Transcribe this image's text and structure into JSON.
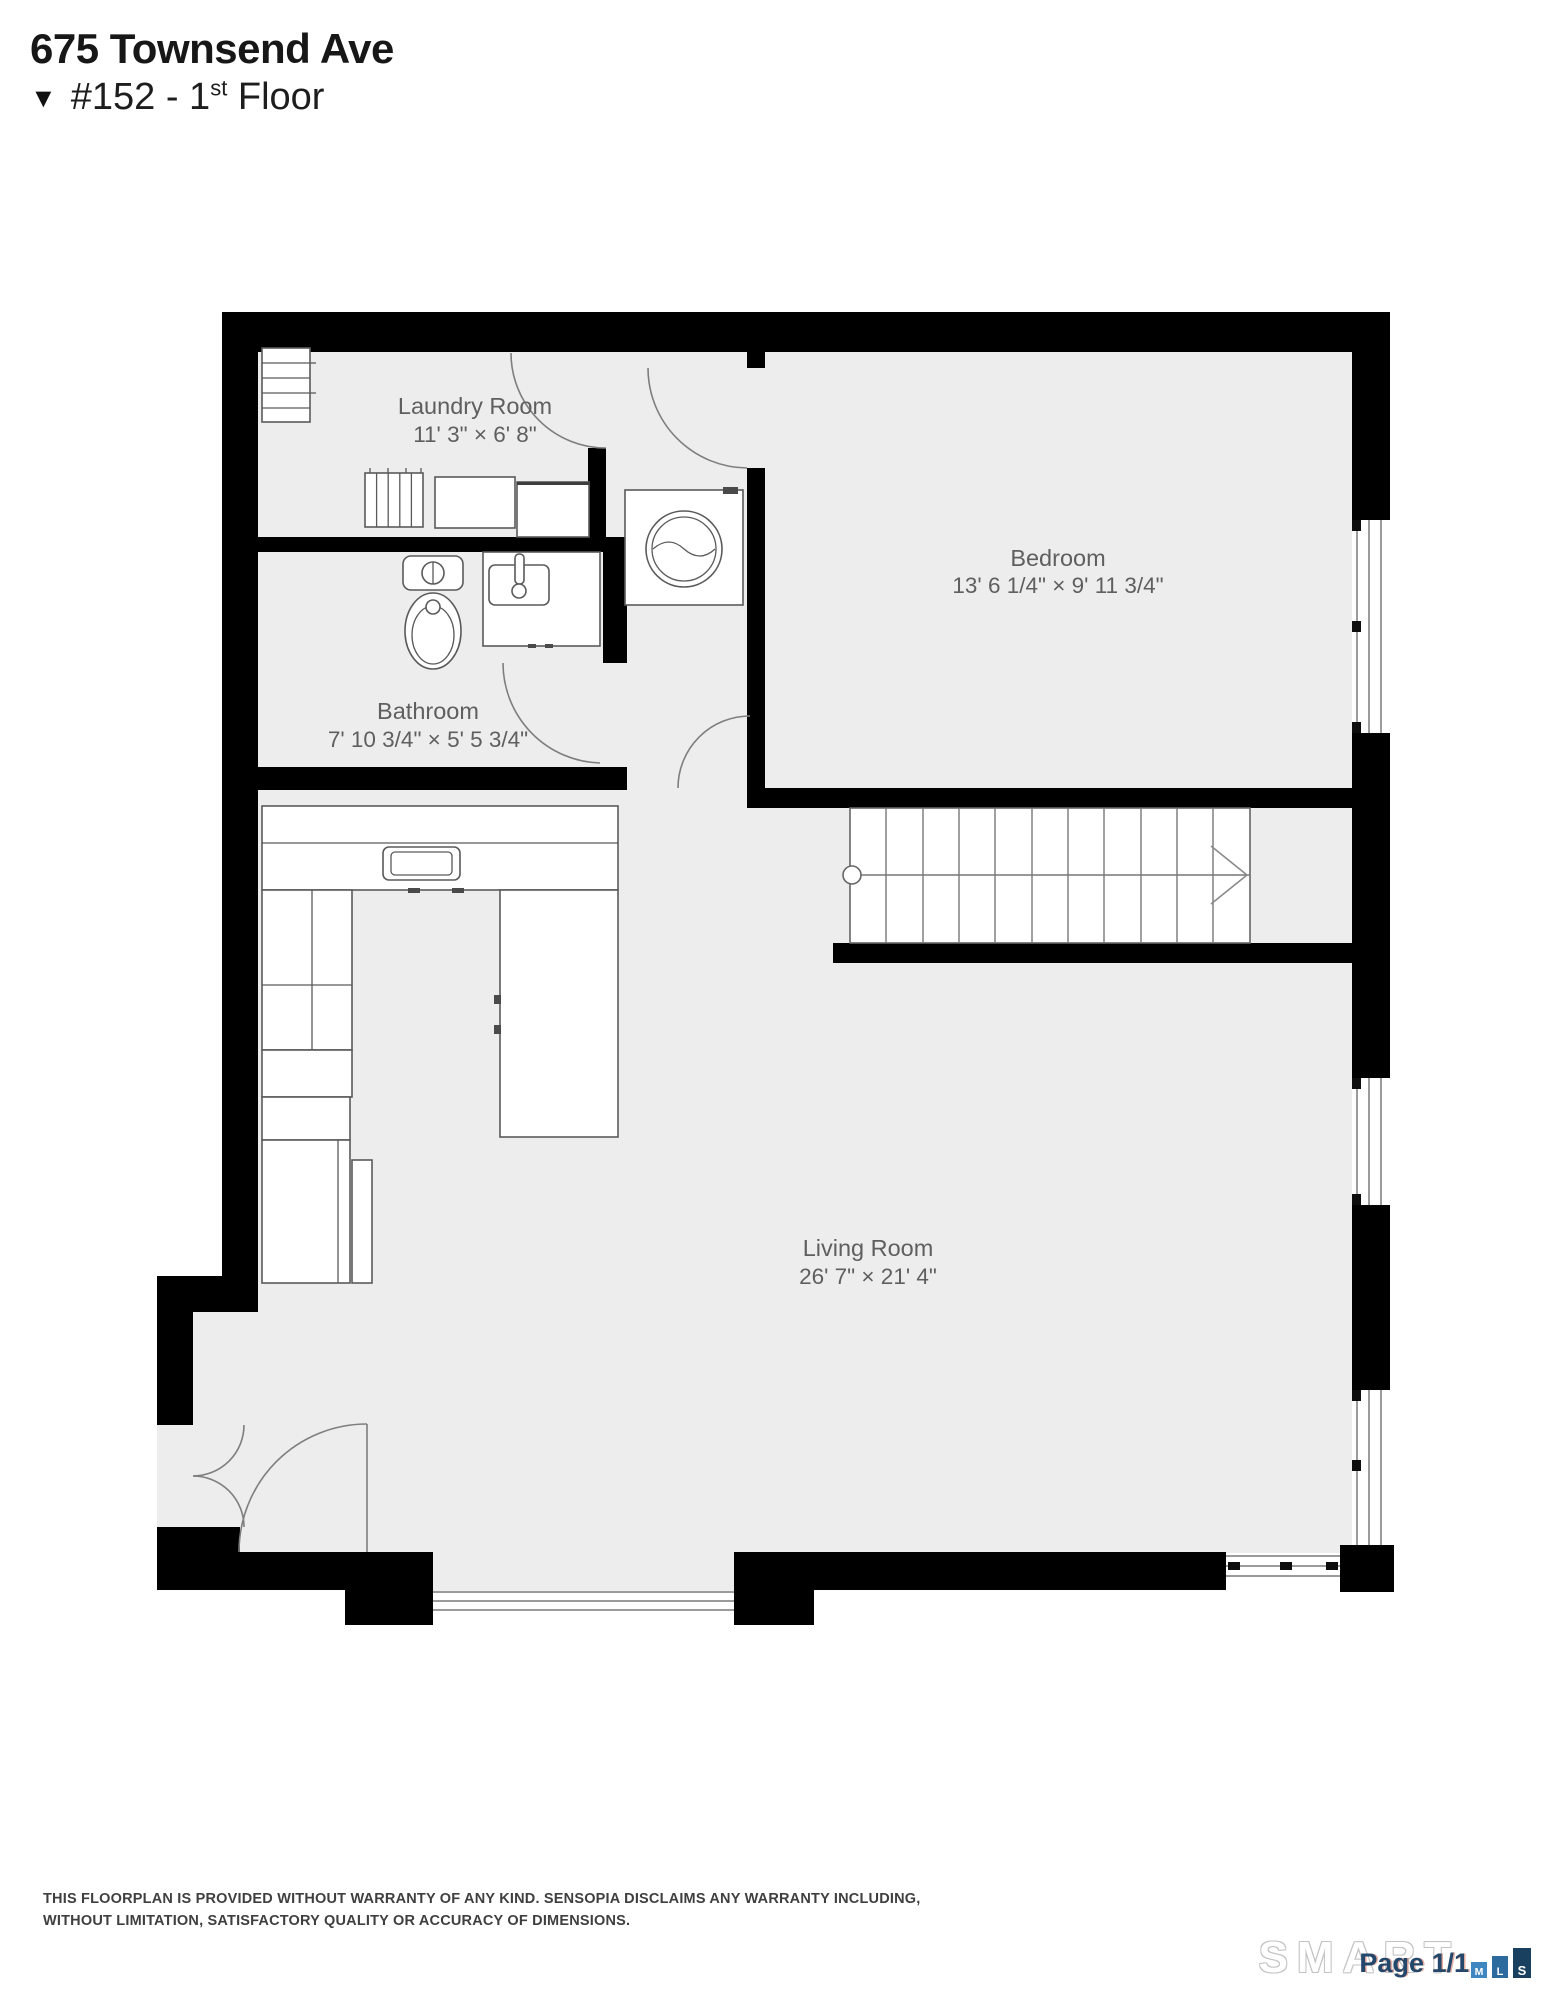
{
  "header": {
    "address": "675 Townsend Ave",
    "floor_marker": "▼",
    "unit": {
      "prefix": "#152 - 1",
      "ordinal": "st",
      "suffix": " Floor"
    }
  },
  "plan": {
    "rooms": [
      {
        "id": "laundry",
        "name": "Laundry Room",
        "dimensions": "11' 3\" × 6' 8\""
      },
      {
        "id": "bedroom",
        "name": "Bedroom",
        "dimensions": "13' 6 1/4\" × 9' 11 3/4\""
      },
      {
        "id": "bathroom",
        "name": "Bathroom",
        "dimensions": "7' 10 3/4\" × 5' 5 3/4\""
      },
      {
        "id": "living",
        "name": "Living Room",
        "dimensions": "26' 7\" × 21' 4\""
      }
    ],
    "colors": {
      "wall": "#000000",
      "floor": "#ededed",
      "label": "#5f5f5f",
      "fixture_stroke": "#5a5a5a"
    }
  },
  "footer": {
    "disclaimer_line1": "THIS FLOORPLAN IS PROVIDED WITHOUT WARRANTY OF ANY KIND. SENSOPIA DISCLAIMS ANY WARRANTY INCLUDING,",
    "disclaimer_line2": "WITHOUT LIMITATION, SATISFACTORY QUALITY OR ACCURACY OF DIMENSIONS.",
    "page_indicator": "Page 1/1",
    "brand": {
      "wordmark": "SMART",
      "letter_blocks": [
        "M",
        "L",
        "S"
      ],
      "block_colors": [
        "#3e87c0",
        "#2d6b9f",
        "#1a4060"
      ]
    }
  }
}
